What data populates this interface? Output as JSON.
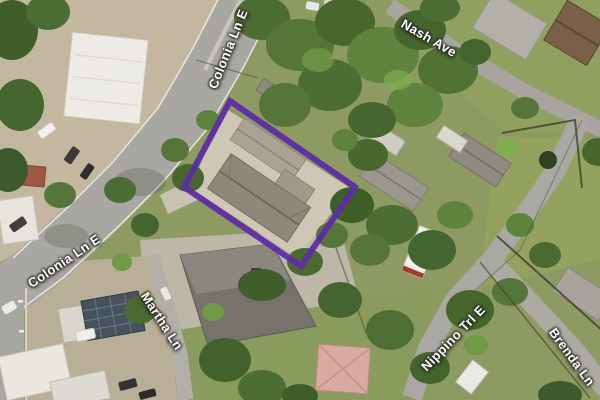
{
  "map": {
    "view": "satellite-aerial",
    "street_labels": [
      {
        "name": "Colonia Ln E",
        "position": "top"
      },
      {
        "name": "Nash Ave",
        "position": "top-right"
      },
      {
        "name": "Colonia Ln E",
        "position": "bottom-left"
      },
      {
        "name": "Martha Ln",
        "position": "bottom-center-left"
      },
      {
        "name": "Nippino Trl E",
        "position": "bottom-right"
      },
      {
        "name": "Brenda Ln",
        "position": "right-edge"
      }
    ],
    "parcel_highlight": {
      "outline_color": "#5e2ca6",
      "shape": "rotated-rectangle"
    },
    "palette": {
      "road": "#a9a7a1",
      "grass": "#8d9a62",
      "tree_dark": "#3c5a2b",
      "tree_mid": "#527134",
      "tree_light": "#6f9a46",
      "dirt": "#c3b89f",
      "parcel_pavement": "#cfc7b5",
      "label_text": "#ffffff"
    }
  }
}
